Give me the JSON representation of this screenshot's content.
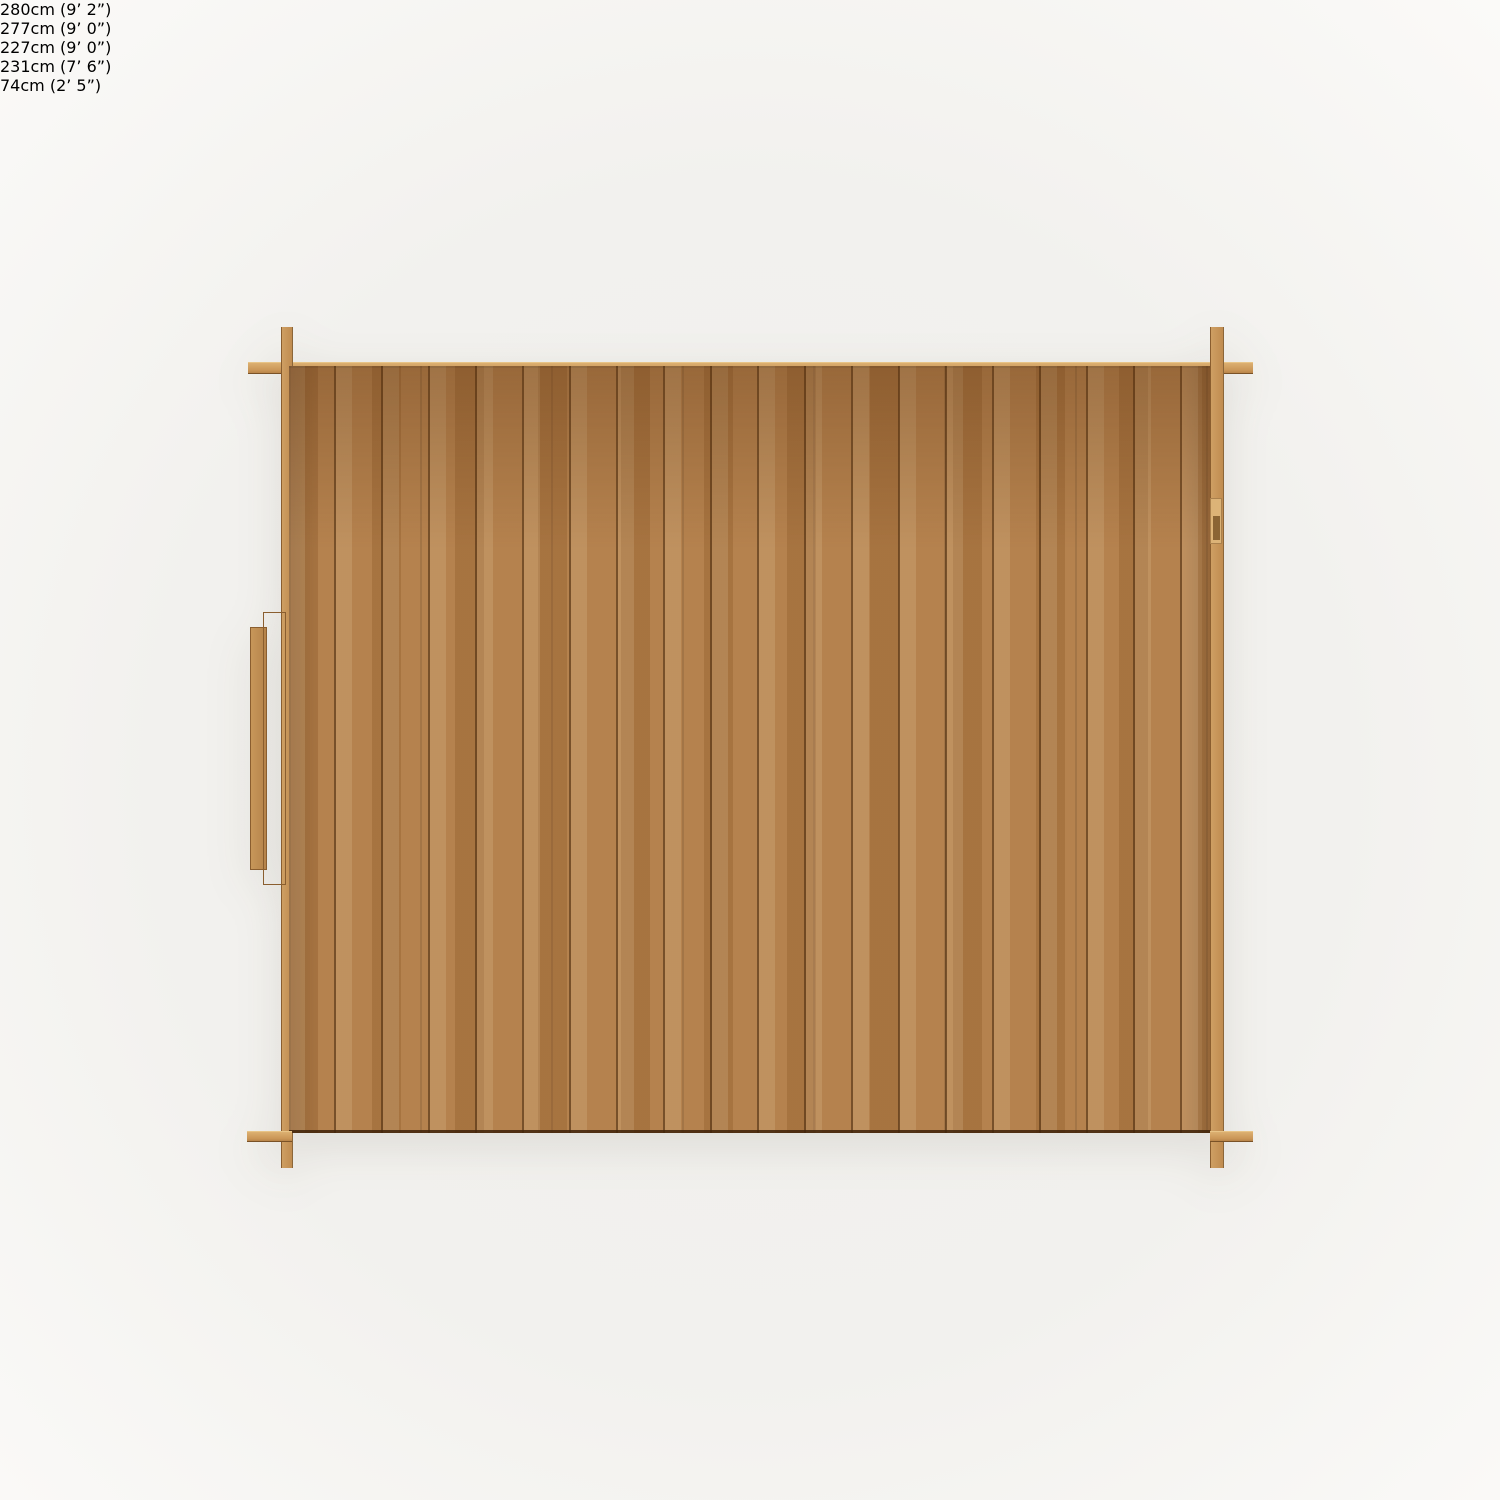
{
  "diagram": {
    "kind": "shed-top-view-dimension-diagram",
    "labels": {
      "outer_width": "280cm (9’ 2”)",
      "inner_width": "277cm (9’ 0”)",
      "inner_depth": "227cm (9’ 0”)",
      "outer_depth": "231cm (7’ 6”)",
      "door_width": "74cm (2’ 5”)"
    },
    "values_cm": {
      "outer_width": 280,
      "inner_width": 277,
      "inner_depth": 227,
      "outer_depth": 231,
      "door_width": 74
    },
    "colors": {
      "background": "#f2f1ee",
      "wood_mid": "#b5824e",
      "wood_light": "#d2a365",
      "wood_seam": "#6e4a22",
      "beam": "#cb9758",
      "label_dark": "#1a1a1a",
      "label_light": "#faf6ee",
      "door_hardware": "#141414"
    }
  }
}
